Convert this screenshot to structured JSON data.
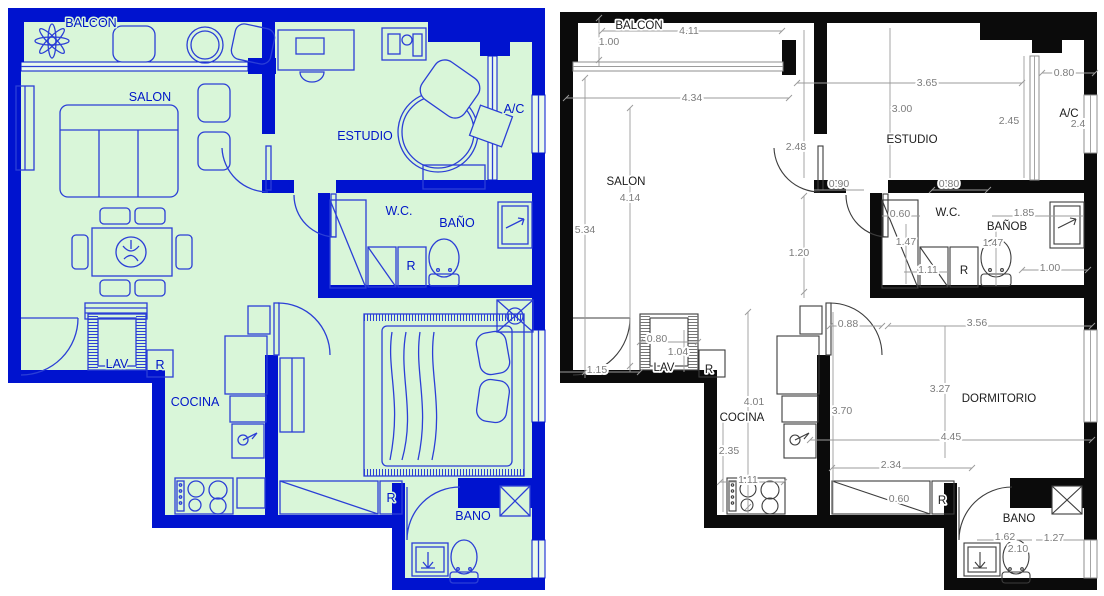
{
  "left_plan": {
    "background_color": "#d9f6d9",
    "wall_color": "#0013cf",
    "line_color": "#2b3fd6",
    "labels": {
      "balcon": "BALCON",
      "salon": "SALON",
      "estudio": "ESTUDIO",
      "ac": "A/C",
      "wc": "W.C.",
      "bano": "BAÑO",
      "r_bano": "R",
      "lav": "LAV",
      "r_lav": "R",
      "cocina": "COCINA",
      "r_closet": "R",
      "bano2": "BANO"
    }
  },
  "right_plan": {
    "background_color": "#ffffff",
    "wall_color": "#0b0b0b",
    "dim_color": "#7c7c7c",
    "labels": {
      "balcon": "BALCON",
      "salon": "SALON",
      "estudio": "ESTUDIO",
      "ac": "A/C",
      "wc": "W.C.",
      "bano": "BAÑOB",
      "r_bano": "R",
      "lav": "LAV",
      "r_lav": "R",
      "cocina": "COCINA",
      "dormitorio": "DORMITORIO",
      "r_closet": "R",
      "bano2": "BANO"
    },
    "dimensions": {
      "balcon_width": "4.11",
      "balcon_depth": "1.00",
      "salon_width": "4.34",
      "estudio_width": "3.65",
      "estudio_depth": "3.00",
      "estudio_window": "2.45",
      "ac_opening": "0.80",
      "ac_width": "2.4",
      "estudio_wall": "2.48",
      "estudio_door": "0.90",
      "salon_depth": "5.34",
      "salon_length": "4.14",
      "hall": "1.20",
      "wc_door": "0.80",
      "wc_closet": "0.60",
      "wc_depth": "1.47",
      "bano_width": "1.85",
      "bano_depth": "1.47",
      "bano_window": "1.00",
      "wc_width": "1.11",
      "dorm_door": "0.88",
      "dorm_top_width": "3.56",
      "lav_door": "0.80",
      "lav_depth": "1.04",
      "entry_door": "1.15",
      "cocina_depth": "4.01",
      "cocina_wall": "3.70",
      "dorm_length": "3.27",
      "cocina_lower": "2.35",
      "stove_width": "1.11",
      "dorm_width": "4.45",
      "closet_width": "2.34",
      "closet_depth": "0.60",
      "bano2_width": "1.62",
      "bano2_inner": "2.10",
      "bano2_depth": "1.27"
    }
  }
}
